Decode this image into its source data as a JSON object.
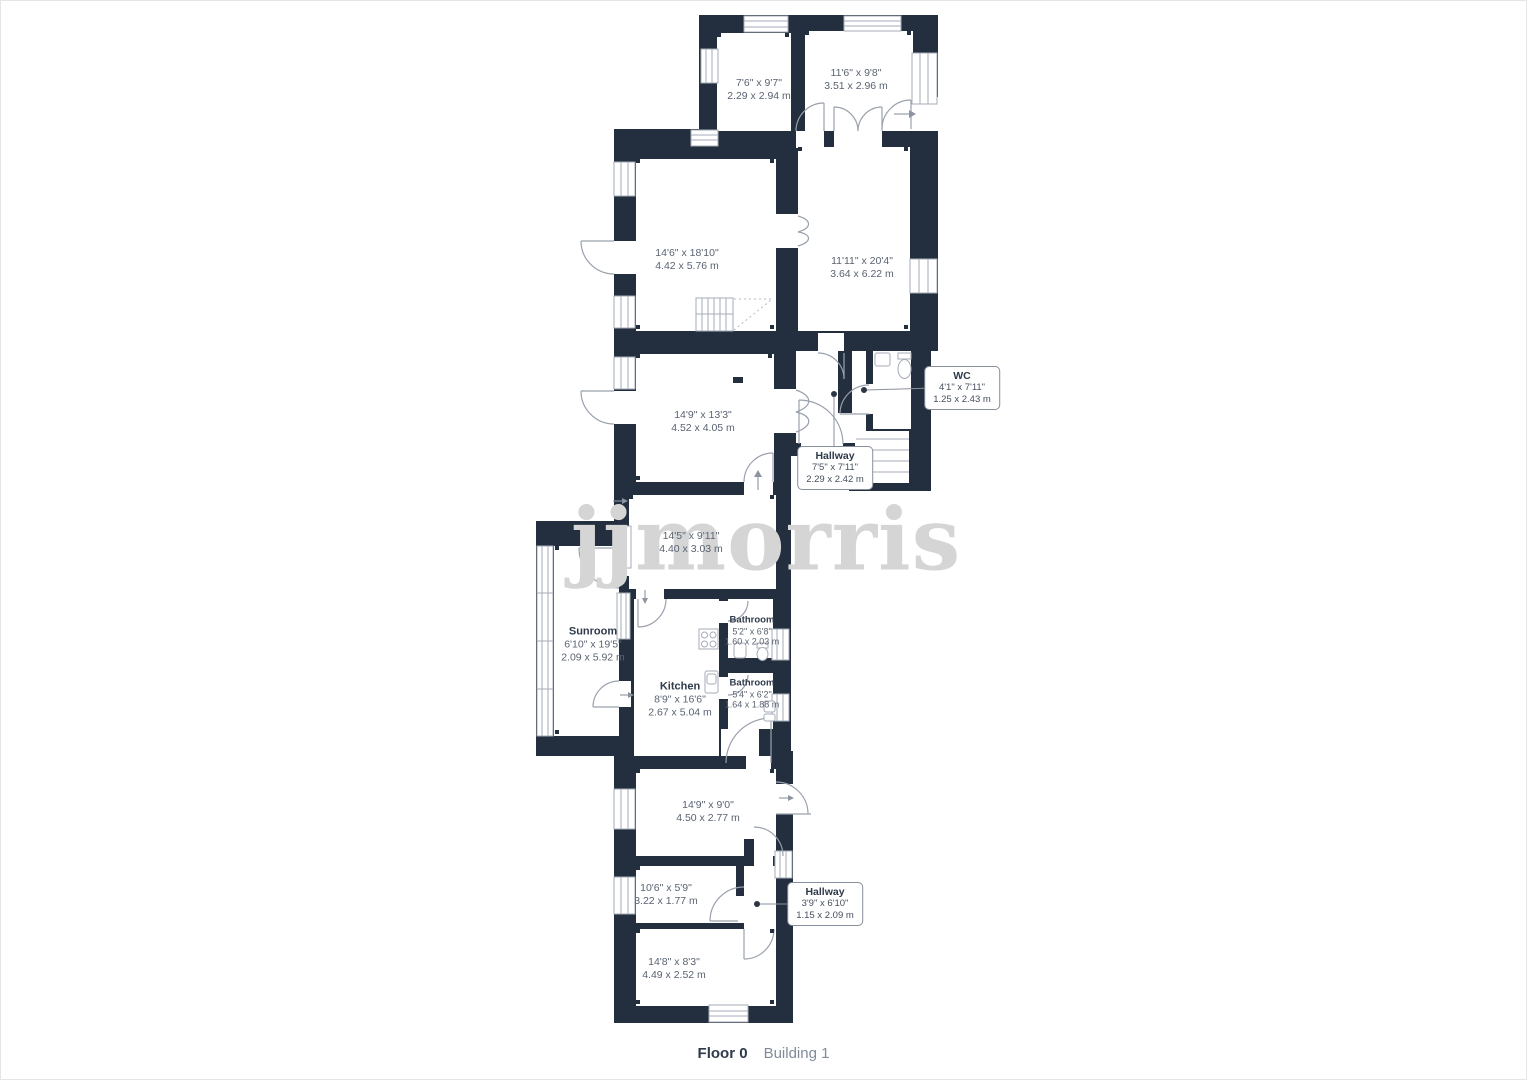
{
  "watermark": "jjmorris",
  "footer": {
    "floor_label": "Floor 0",
    "building_label": "Building 1"
  },
  "colors": {
    "wall": "#232e3e",
    "door_window_stroke": "#9aa1ac",
    "label_text": "#5a6372",
    "room_name_text": "#2f3a4a",
    "watermark": "#d5d5d5",
    "callout_border": "#858e9b",
    "page_border": "#e4e5e7"
  },
  "rooms": [
    {
      "name": "",
      "imperial": "7'6\" x 9'7\"",
      "metric": "2.29 x 2.94 m"
    },
    {
      "name": "",
      "imperial": "11'6\" x 9'8\"",
      "metric": "3.51 x 2.96 m"
    },
    {
      "name": "",
      "imperial": "14'6\" x 18'10\"",
      "metric": "4.42 x 5.76 m"
    },
    {
      "name": "",
      "imperial": "11'11\" x 20'4\"",
      "metric": "3.64 x 6.22 m"
    },
    {
      "name": "",
      "imperial": "14'9\" x 13'3\"",
      "metric": "4.52 x 4.05 m"
    },
    {
      "name": "",
      "imperial": "14'5\" x 9'11\"",
      "metric": "4.40 x 3.03 m"
    },
    {
      "name": "Sunroom",
      "imperial": "6'10\" x 19'5\"",
      "metric": "2.09 x 5.92 m"
    },
    {
      "name": "Kitchen",
      "imperial": "8'9\" x 16'6\"",
      "metric": "2.67 x 5.04 m"
    },
    {
      "name": "Bathroom",
      "imperial": "5'2\" x 6'8\"",
      "metric": "1.60 x 2.03 m"
    },
    {
      "name": "Bathroom",
      "imperial": "5'4\" x 6'2\"",
      "metric": "1.64 x 1.88 m"
    },
    {
      "name": "",
      "imperial": "14'9\" x 9'0\"",
      "metric": "4.50 x 2.77 m"
    },
    {
      "name": "",
      "imperial": "10'6\" x 5'9\"",
      "metric": "3.22 x 1.77 m"
    },
    {
      "name": "",
      "imperial": "14'8\" x 8'3\"",
      "metric": "4.49 x 2.52 m"
    }
  ],
  "callouts": [
    {
      "name": "WC",
      "imperial": "4'1\" x 7'11\"",
      "metric": "1.25 x 2.43 m"
    },
    {
      "name": "Hallway",
      "imperial": "7'5\" x 7'11\"",
      "metric": "2.29 x 2.42 m"
    },
    {
      "name": "Hallway",
      "imperial": "3'9\" x 6'10\"",
      "metric": "1.15 x 2.09 m"
    }
  ]
}
